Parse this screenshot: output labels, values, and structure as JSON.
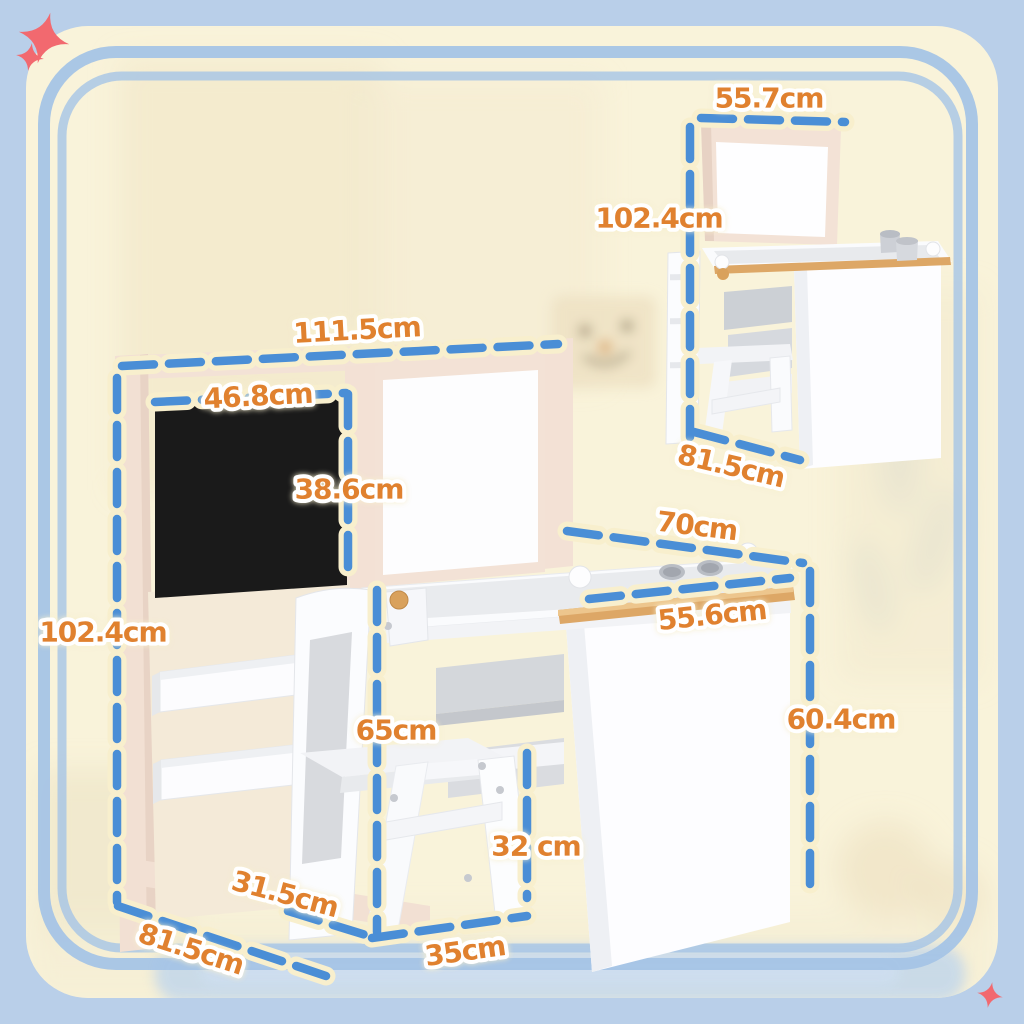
{
  "page": {
    "background": "#b9cfe9",
    "card": "#f9f3da",
    "border_blue": "#a5c4e6",
    "sparkle_red": "#f2696f"
  },
  "annotation_style": {
    "dash_color": "#4a8ed6",
    "halo_color": "#f8efcd",
    "label_color": "#e0812f",
    "unit": "cm"
  },
  "main_view": {
    "description": "kids easel desk with blackboard, whiteboard, storage trays and chair",
    "dimensions": {
      "frame_width": "111.5cm",
      "blackboard_width": "46.8cm",
      "blackboard_height": "38.6cm",
      "frame_height": "102.4cm",
      "desk_top_width": "70cm",
      "desk_top_depth": "55.6cm",
      "desk_height": "60.4cm",
      "chair_back_height": "65cm",
      "chair_seat_height": "32 cm",
      "chair_depth": "31.5cm",
      "chair_width": "35cm",
      "base_depth": "81.5cm"
    }
  },
  "inset_view": {
    "description": "desk folded flat with whiteboard raised and chair tucked",
    "dimensions": {
      "width": "55.7cm",
      "height": "102.4cm",
      "depth": "81.5cm"
    }
  }
}
